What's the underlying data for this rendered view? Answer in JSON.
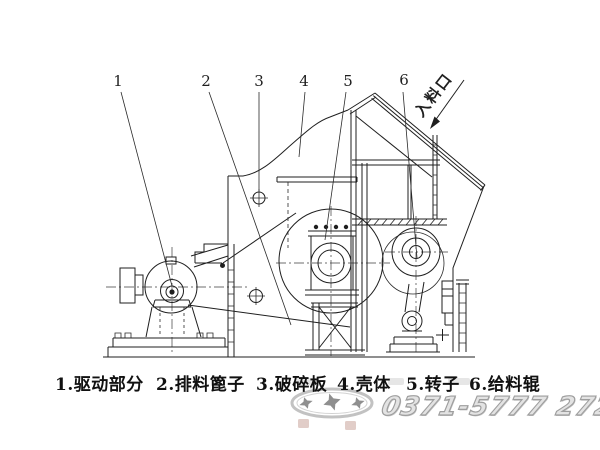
{
  "diagram": {
    "title_context": "crusher-section-diagram",
    "inlet_label": "入料口",
    "parts": [
      {
        "number": "1",
        "name": "驱动部分",
        "label": "1.驱动部分"
      },
      {
        "number": "2",
        "name": "排料篦子",
        "label": "2.排料篦子"
      },
      {
        "number": "3",
        "name": "破碎板",
        "label": "3.破碎板"
      },
      {
        "number": "4",
        "name": "壳体",
        "label": "4.壳体"
      },
      {
        "number": "5",
        "name": "转子",
        "label": "5.转子"
      },
      {
        "number": "6",
        "name": "给料辊",
        "label": "6.给料辊"
      }
    ],
    "watermark": {
      "phone": "0371-5777 2727"
    },
    "colors": {
      "line": "#1f1f1f",
      "watermark_gray": "#b5b5b5",
      "phone_gray": "#9e9e9e"
    }
  }
}
